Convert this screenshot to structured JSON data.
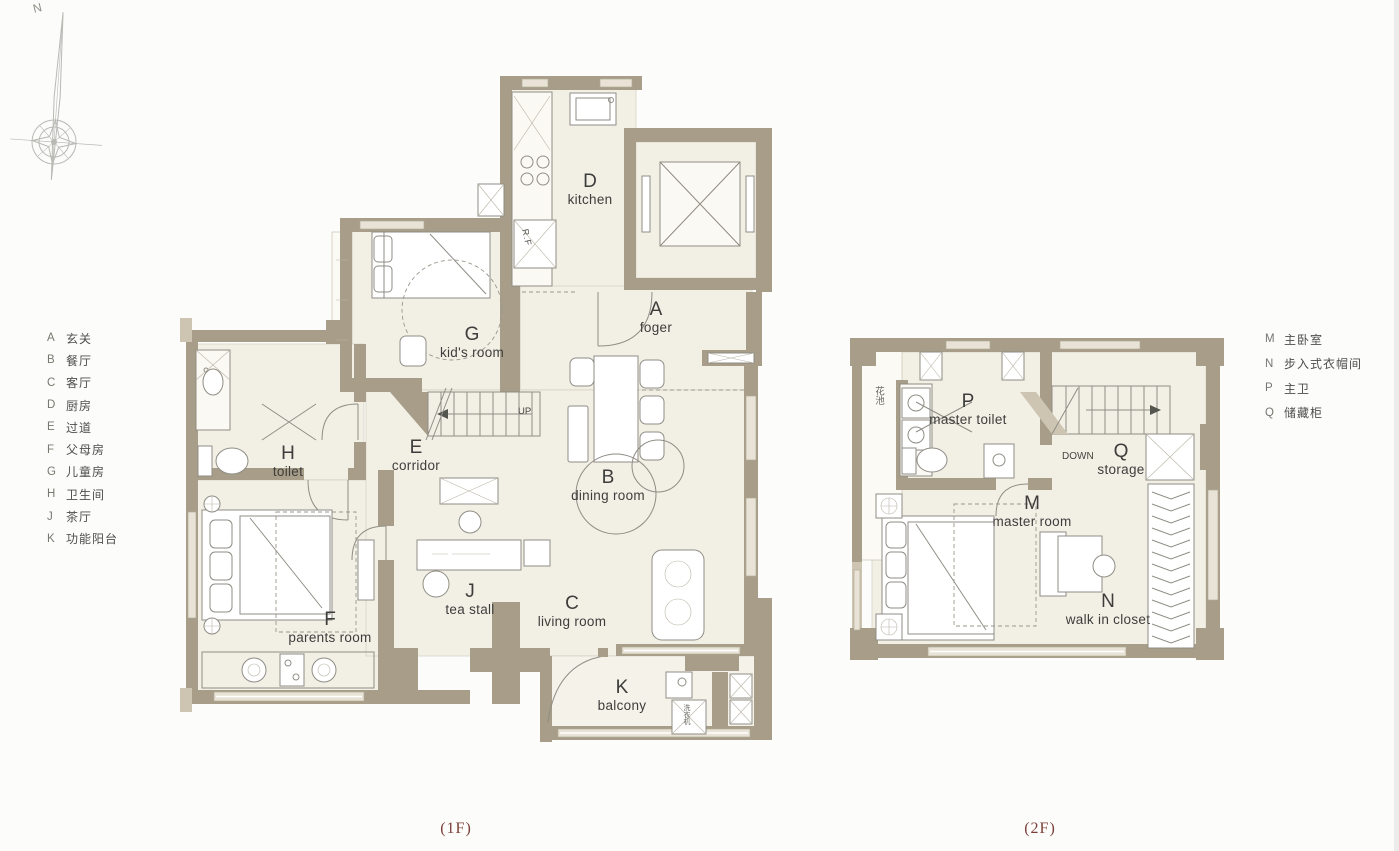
{
  "compass": {
    "north": "N"
  },
  "legend_left": {
    "items": [
      {
        "letter": "A",
        "label": "玄关"
      },
      {
        "letter": "B",
        "label": "餐厅"
      },
      {
        "letter": "C",
        "label": "客厅"
      },
      {
        "letter": "D",
        "label": "厨房"
      },
      {
        "letter": "E",
        "label": "过道"
      },
      {
        "letter": "F",
        "label": "父母房"
      },
      {
        "letter": "G",
        "label": "儿童房"
      },
      {
        "letter": "H",
        "label": "卫生间"
      },
      {
        "letter": "J",
        "label": "茶厅"
      },
      {
        "letter": "K",
        "label": "功能阳台"
      }
    ]
  },
  "legend_right": {
    "items": [
      {
        "letter": "M",
        "label": "主卧室"
      },
      {
        "letter": "N",
        "label": "步入式衣帽间"
      },
      {
        "letter": "P",
        "label": "主卫"
      },
      {
        "letter": "Q",
        "label": "储藏柜"
      }
    ]
  },
  "floor1": {
    "caption": "(1F)",
    "rooms": {
      "kitchen": {
        "letter": "D",
        "name": "kitchen"
      },
      "foyer": {
        "letter": "A",
        "name": "foger"
      },
      "kids_room": {
        "letter": "G",
        "name": "kid's room"
      },
      "corridor": {
        "letter": "E",
        "name": "corridor"
      },
      "toilet": {
        "letter": "H",
        "name": "toilet"
      },
      "dining": {
        "letter": "B",
        "name": "dining room"
      },
      "parents": {
        "letter": "F",
        "name": "parents room"
      },
      "tea": {
        "letter": "J",
        "name": "tea stall"
      },
      "living": {
        "letter": "C",
        "name": "living room"
      },
      "balcony": {
        "letter": "K",
        "name": "balcony"
      }
    },
    "annotations": {
      "stairs": "UP",
      "fridge": "R.F",
      "washer": "洗衣机"
    }
  },
  "floor2": {
    "caption": "(2F)",
    "rooms": {
      "master_toilet": {
        "letter": "P",
        "name": "master toilet"
      },
      "storage": {
        "letter": "Q",
        "name": "storage"
      },
      "master_room": {
        "letter": "M",
        "name": "master room"
      },
      "closet": {
        "letter": "N",
        "name": "walk in closet"
      }
    },
    "annotations": {
      "stairs": "DOWN",
      "flower_bed": "花池"
    }
  },
  "colors": {
    "wall": "#a79d88",
    "floor": "#f2efe5",
    "caption_red": "#7c403a"
  }
}
